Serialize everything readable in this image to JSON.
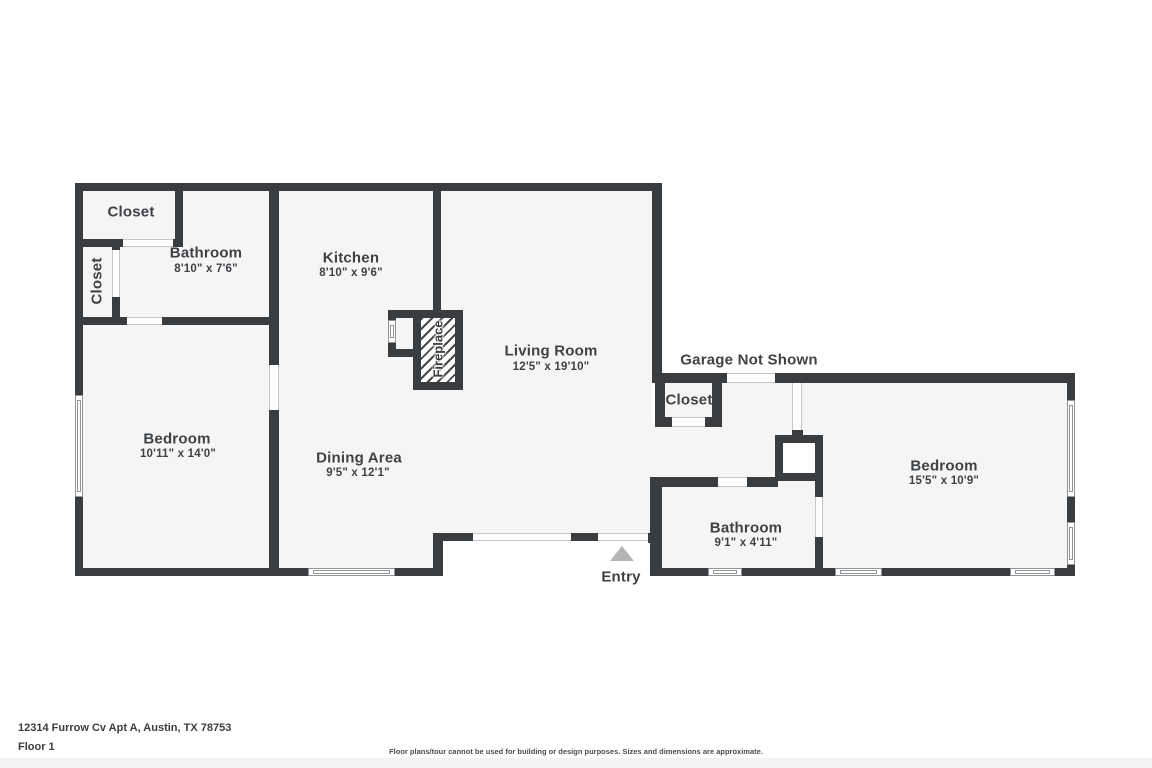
{
  "floorplan": {
    "rooms": {
      "closet_tl": {
        "name": "Closet"
      },
      "closet_left": {
        "name": "Closet"
      },
      "bathroom1": {
        "name": "Bathroom",
        "dims": "8'10\" x 7'6\""
      },
      "kitchen": {
        "name": "Kitchen",
        "dims": "8'10\" x 9'6\""
      },
      "living": {
        "name": "Living Room",
        "dims": "12'5\" x 19'10\""
      },
      "bedroom_left": {
        "name": "Bedroom",
        "dims": "10'11\" x 14'0\""
      },
      "dining": {
        "name": "Dining Area",
        "dims": "9'5\" x 12'1\""
      },
      "garage_note": {
        "name": "Garage Not Shown"
      },
      "closet_right": {
        "name": "Closet"
      },
      "bedroom_right": {
        "name": "Bedroom",
        "dims": "15'5\" x 10'9\""
      },
      "bathroom2": {
        "name": "Bathroom",
        "dims": "9'1\" x 4'11\""
      },
      "fireplace": {
        "name": "Fireplace"
      },
      "entry": {
        "name": "Entry"
      }
    },
    "colors": {
      "wall": "#3a3d40",
      "room_fill": "#f5f5f6",
      "label_text": "#3f4245",
      "entry_arrow": "#b2b4b6"
    },
    "footer": {
      "address": "12314 Furrow Cv Apt A, Austin, TX 78753",
      "floor": "Floor 1",
      "disclaimer": "Floor plans/tour cannot be used for building or design purposes. Sizes and dimensions are approximate."
    }
  }
}
